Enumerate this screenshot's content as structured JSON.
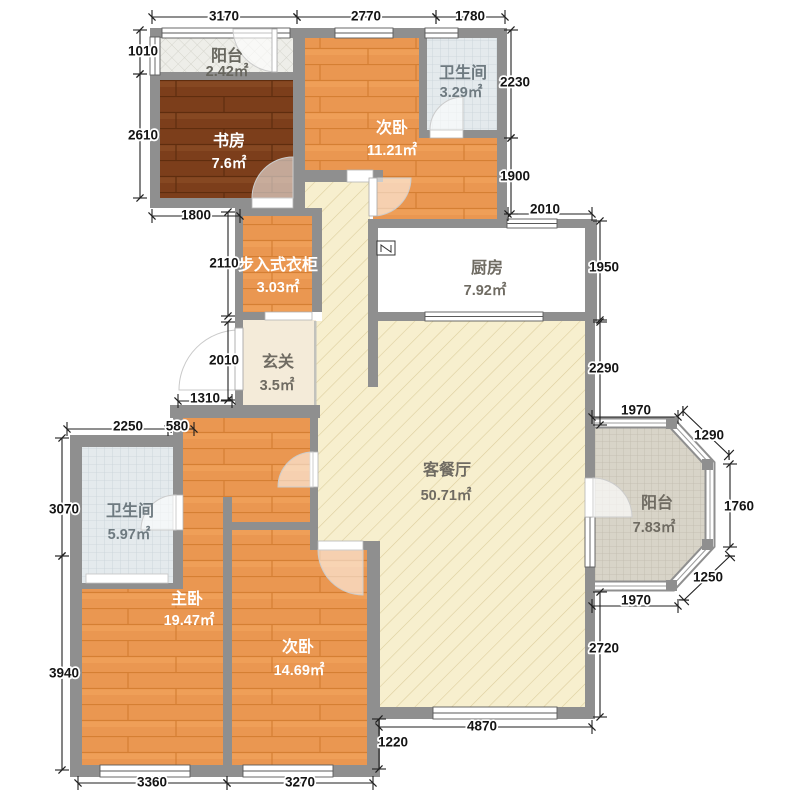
{
  "plan": {
    "title": "apartment-floor-plan",
    "unit_note": "",
    "rooms": [
      {
        "id": "balcony-top",
        "name": "阳台",
        "area": "2.42㎡",
        "color": "#67665e",
        "nx": 227,
        "ny": 57,
        "ax": 227,
        "ay": 72
      },
      {
        "id": "study",
        "name": "书房",
        "area": "7.6㎡",
        "color": "#ffffff",
        "nx": 229,
        "ny": 142,
        "ax": 229,
        "ay": 164
      },
      {
        "id": "bedroom-top",
        "name": "次卧",
        "area": "11.21㎡",
        "color": "#ffffff",
        "nx": 392,
        "ny": 129,
        "ax": 392,
        "ay": 151
      },
      {
        "id": "bathroom-top",
        "name": "卫生间",
        "area": "3.29㎡",
        "color": "#6e7a80",
        "nx": 463,
        "ny": 74,
        "ax": 461,
        "ay": 93
      },
      {
        "id": "closet",
        "name": "步入式衣柜",
        "area": "3.03㎡",
        "color": "#ffffff",
        "nx": 278,
        "ny": 266,
        "ax": 278,
        "ay": 288
      },
      {
        "id": "foyer",
        "name": "玄关",
        "area": "3.5㎡",
        "color": "#6f6b62",
        "nx": 278,
        "ny": 363,
        "ax": 277,
        "ay": 386
      },
      {
        "id": "kitchen",
        "name": "厨房",
        "area": "7.92㎡",
        "color": "#6f6b62",
        "nx": 487,
        "ny": 269,
        "ax": 485,
        "ay": 291
      },
      {
        "id": "living-dining",
        "name": "客餐厅",
        "area": "50.71㎡",
        "color": "#6f6b62",
        "nx": 447,
        "ny": 471,
        "ax": 446,
        "ay": 496
      },
      {
        "id": "balcony-right",
        "name": "阳台",
        "area": "7.83㎡",
        "color": "#6f6b62",
        "nx": 657,
        "ny": 504,
        "ax": 654,
        "ay": 528
      },
      {
        "id": "bathroom-bottom",
        "name": "卫生间",
        "area": "5.97㎡",
        "color": "#6e7a80",
        "nx": 130,
        "ny": 512,
        "ax": 129,
        "ay": 535
      },
      {
        "id": "master-bedroom",
        "name": "主卧",
        "area": "19.47㎡",
        "color": "#ffffff",
        "nx": 187,
        "ny": 600,
        "ax": 189,
        "ay": 621
      },
      {
        "id": "bedroom-bottom",
        "name": "次卧",
        "area": "14.69㎡",
        "color": "#ffffff",
        "nx": 298,
        "ny": 648,
        "ax": 299,
        "ay": 671
      }
    ],
    "dimensions": [
      {
        "label": "3170",
        "x1": 152,
        "y1": 17,
        "x2": 297,
        "y2": 17,
        "tx": 224,
        "ty": 17
      },
      {
        "label": "2770",
        "x1": 297,
        "y1": 17,
        "x2": 436,
        "y2": 17,
        "tx": 366,
        "ty": 17
      },
      {
        "label": "1780",
        "x1": 436,
        "y1": 17,
        "x2": 505,
        "y2": 17,
        "tx": 470,
        "ty": 17
      },
      {
        "label": "1010",
        "x1": 140,
        "y1": 30,
        "x2": 140,
        "y2": 74,
        "tx": 143,
        "ty": 52
      },
      {
        "label": "2610",
        "x1": 140,
        "y1": 74,
        "x2": 140,
        "y2": 198,
        "tx": 143,
        "ty": 136
      },
      {
        "label": "1800",
        "x1": 152,
        "y1": 216,
        "x2": 240,
        "y2": 216,
        "tx": 196,
        "ty": 216
      },
      {
        "label": "2110",
        "x1": 228,
        "y1": 212,
        "x2": 228,
        "y2": 316,
        "tx": 224,
        "ty": 264
      },
      {
        "label": "2010",
        "x1": 228,
        "y1": 322,
        "x2": 228,
        "y2": 400,
        "tx": 224,
        "ty": 361
      },
      {
        "label": "1310",
        "x1": 178,
        "y1": 401,
        "x2": 232,
        "y2": 401,
        "tx": 205,
        "ty": 399
      },
      {
        "label": "2250",
        "x1": 67,
        "y1": 429,
        "x2": 168,
        "y2": 429,
        "tx": 128,
        "ty": 427
      },
      {
        "label": "580",
        "x1": 168,
        "y1": 429,
        "x2": 194,
        "y2": 429,
        "tx": 177,
        "ty": 427
      },
      {
        "label": "3070",
        "x1": 62,
        "y1": 438,
        "x2": 62,
        "y2": 556,
        "tx": 64,
        "ty": 510
      },
      {
        "label": "3940",
        "x1": 62,
        "y1": 556,
        "x2": 62,
        "y2": 770,
        "tx": 64,
        "ty": 674
      },
      {
        "label": "3360",
        "x1": 78,
        "y1": 783,
        "x2": 227,
        "y2": 783,
        "tx": 152,
        "ty": 783
      },
      {
        "label": "3270",
        "x1": 227,
        "y1": 783,
        "x2": 373,
        "y2": 783,
        "tx": 300,
        "ty": 783
      },
      {
        "label": "1220",
        "x1": 379,
        "y1": 719,
        "x2": 379,
        "y2": 769,
        "tx": 393,
        "ty": 743
      },
      {
        "label": "4870",
        "x1": 379,
        "y1": 727,
        "x2": 592,
        "y2": 727,
        "tx": 482,
        "ty": 727
      },
      {
        "label": "2720",
        "x1": 600,
        "y1": 592,
        "x2": 600,
        "y2": 717,
        "tx": 604,
        "ty": 649
      },
      {
        "label": "1970",
        "x1": 592,
        "y1": 606,
        "x2": 678,
        "y2": 606,
        "tx": 636,
        "ty": 601
      },
      {
        "label": "1250",
        "x1": 684,
        "y1": 600,
        "x2": 730,
        "y2": 556,
        "tx": 708,
        "ty": 578
      },
      {
        "label": "1760",
        "x1": 730,
        "y1": 464,
        "x2": 730,
        "y2": 547,
        "tx": 739,
        "ty": 507
      },
      {
        "label": "1290",
        "x1": 683,
        "y1": 411,
        "x2": 729,
        "y2": 455,
        "tx": 709,
        "ty": 436
      },
      {
        "label": "1970",
        "x1": 592,
        "y1": 417,
        "x2": 678,
        "y2": 417,
        "tx": 636,
        "ty": 411
      },
      {
        "label": "2290",
        "x1": 600,
        "y1": 322,
        "x2": 600,
        "y2": 425,
        "tx": 604,
        "ty": 369
      },
      {
        "label": "1950",
        "x1": 600,
        "y1": 221,
        "x2": 600,
        "y2": 320,
        "tx": 604,
        "ty": 268
      },
      {
        "label": "2010",
        "x1": 508,
        "y1": 214,
        "x2": 592,
        "y2": 214,
        "tx": 545,
        "ty": 210
      },
      {
        "label": "1900",
        "x1": 511,
        "y1": 138,
        "x2": 511,
        "y2": 214,
        "tx": 515,
        "ty": 177
      },
      {
        "label": "2230",
        "x1": 511,
        "y1": 30,
        "x2": 511,
        "y2": 138,
        "tx": 515,
        "ty": 83
      }
    ],
    "icons": [
      {
        "name": "kitchen-appliance-symbol",
        "glyph": "N"
      }
    ],
    "colors": {
      "wall": "#8f8f8f",
      "wood_orange": "#ea9751",
      "wood_dark": "#7c3e1b",
      "living_floor": "#f7efce",
      "kitchen_tile": "#e7e8ea",
      "bath_tile": "#e4eaed",
      "balcony_tile": "#d8d4c8",
      "dim_text": "#141414"
    }
  }
}
